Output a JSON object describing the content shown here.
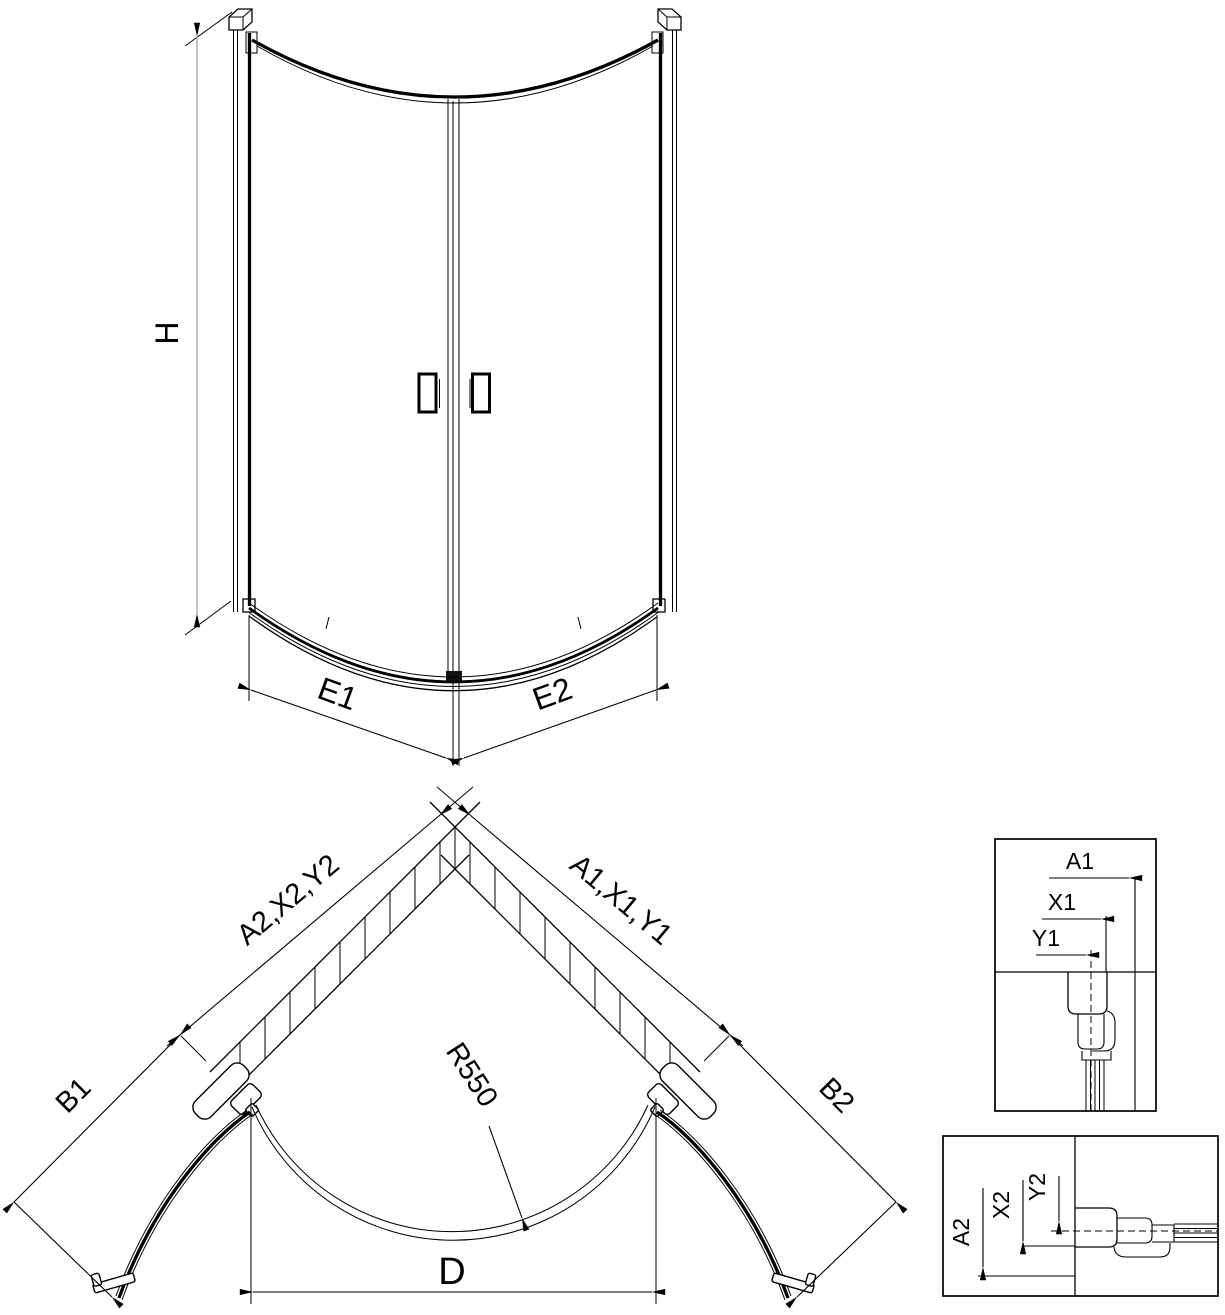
{
  "front_view": {
    "height": "H",
    "left_door_width": "E1",
    "right_door_width": "E2"
  },
  "plan_view": {
    "left_wall_dims": "A2,X2,Y2",
    "right_wall_dims": "A1,X1,Y1",
    "left_door_dim": "B1",
    "right_door_dim": "B2",
    "radius_dim": "R550",
    "entry_width_dim": "D"
  },
  "detail_right": {
    "a": "A1",
    "x": "X1",
    "y": "Y1"
  },
  "detail_left": {
    "a": "A2",
    "x": "X2",
    "y": "Y2"
  },
  "colors": {
    "line": "#000000",
    "dim_line": "#9c9c9c",
    "background": "#ffffff"
  }
}
